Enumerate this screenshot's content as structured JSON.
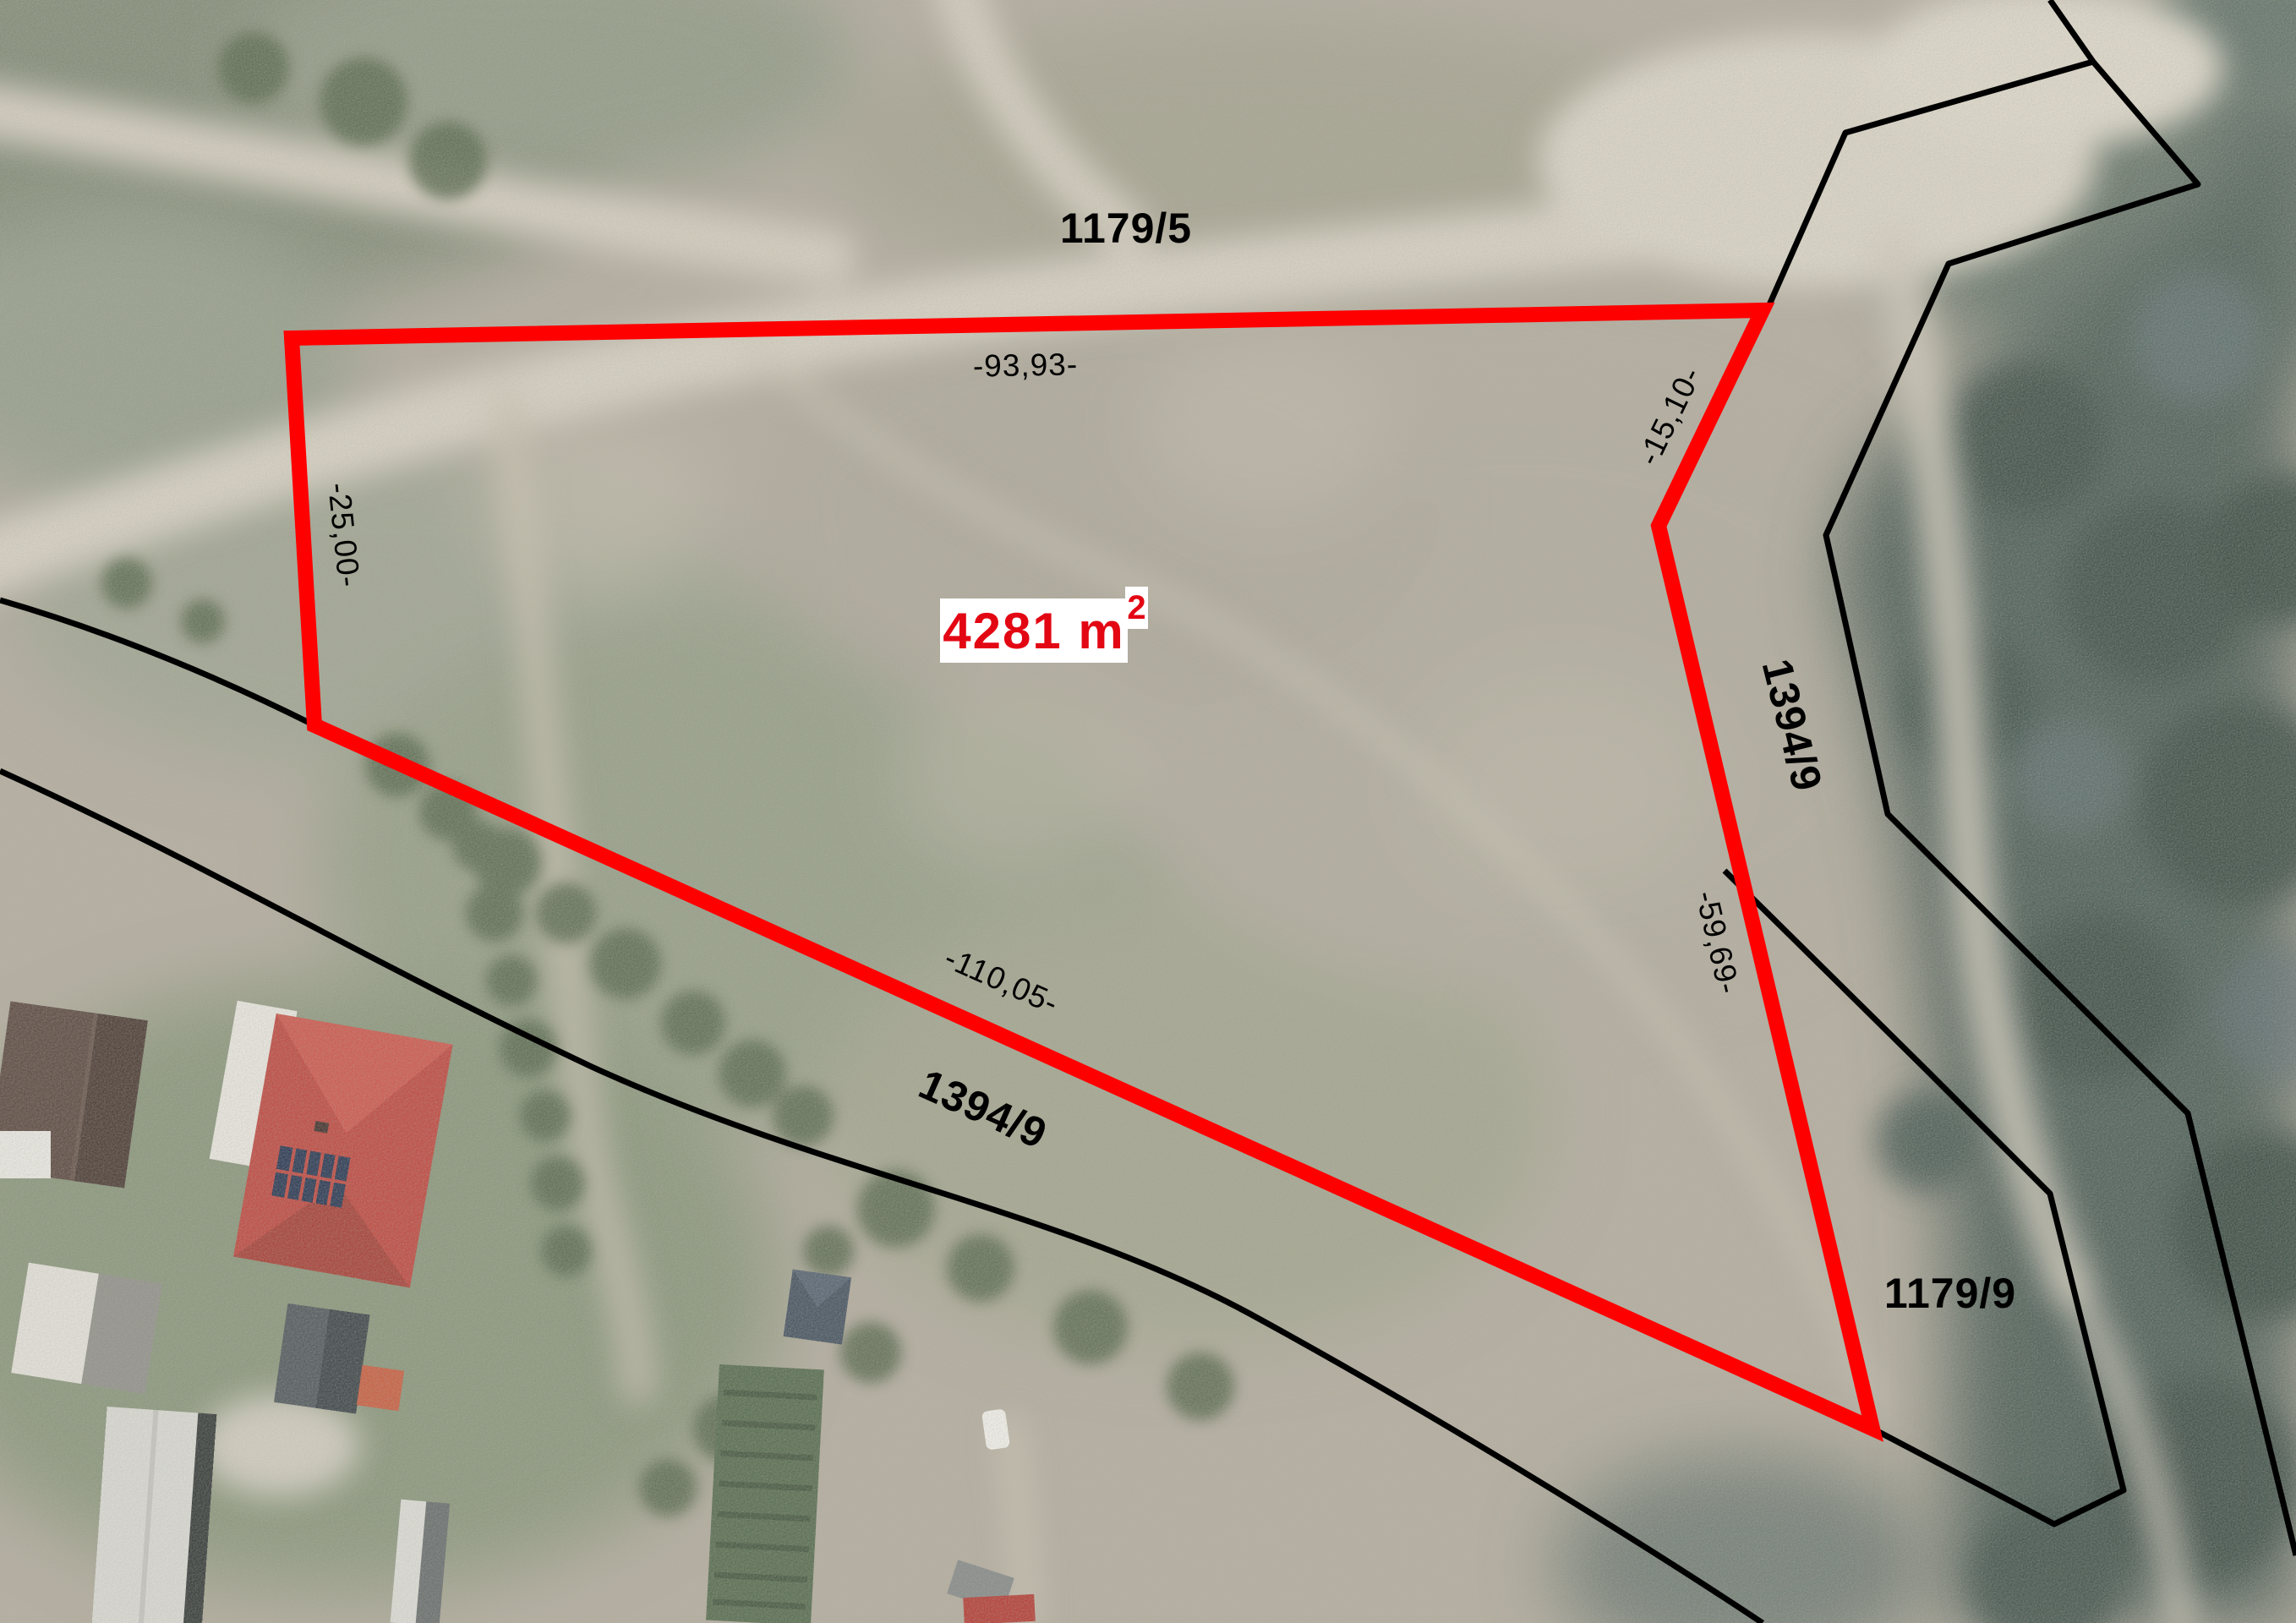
{
  "map": {
    "description": "aerial-cadastral-parcel-map",
    "area_label": {
      "text": "4281 m",
      "exponent": "2"
    },
    "parcel_labels": {
      "top": "1179/5",
      "right": "1394/9",
      "bottom": "1394/9",
      "bottom_right": "1179/9"
    },
    "dimension_labels": {
      "top": "-93,93-",
      "left": "-25,00-",
      "top_right": "-15,10-",
      "right": "-59,69-",
      "bottom": "-110,05-"
    },
    "colors": {
      "plot_outline": "#fe0000",
      "cadastral_line": "#000000",
      "label_text": "#000000",
      "area_text": "#e30613",
      "area_background": "#ffffff"
    }
  }
}
